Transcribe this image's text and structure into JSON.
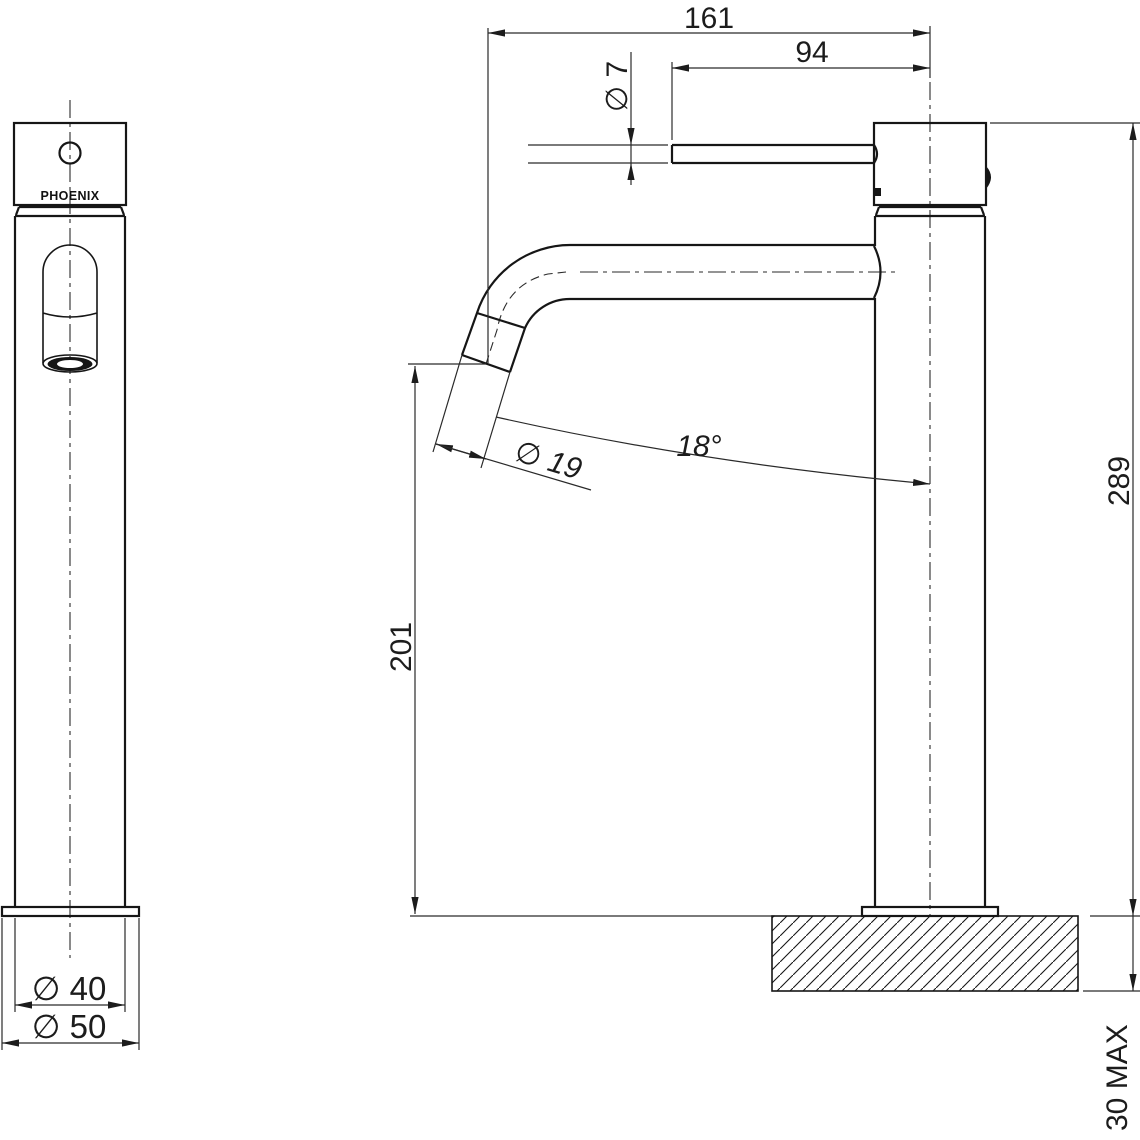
{
  "drawing": {
    "brand_label": "PHOENIX",
    "dimensions": {
      "overall_width": "161",
      "spout_projection": "94",
      "handle_lever_dia": "∅ 7",
      "spout_outlet_dia": "∅ 19",
      "spout_angle": "18°",
      "outlet_height": "201",
      "overall_height": "289",
      "body_dia": "∅ 40",
      "base_dia": "∅ 50",
      "deck_thickness_max": "30 MAX"
    },
    "colors": {
      "line": "#161616",
      "dimension_line": "#2a2a2a",
      "background": "#ffffff"
    }
  }
}
